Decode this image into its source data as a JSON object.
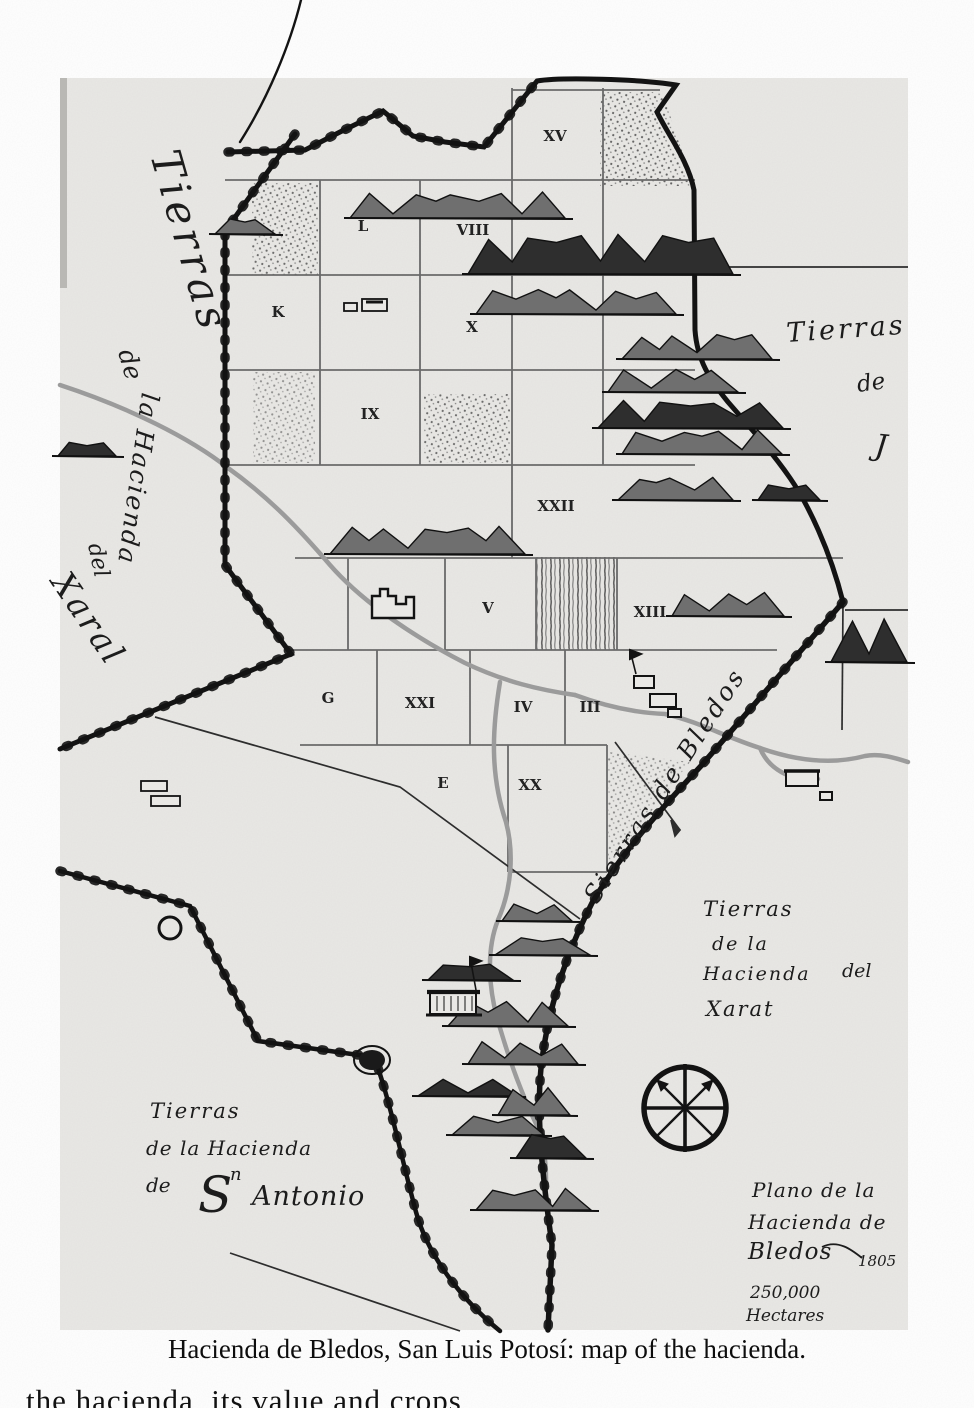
{
  "page": {
    "caption": "Hacienda de Bledos, San Luis Potosí: map of the hacienda.",
    "cropped_bottom_text": "the hacienda, its value and crops"
  },
  "map": {
    "territory_labels": {
      "west": [
        "Tierras",
        "de",
        "la Hacienda",
        "del",
        "Xaral"
      ],
      "east_edge": [
        "Tierras",
        "de",
        "J"
      ],
      "sierras_boundary": "Sierras de Bledos",
      "southeast": [
        "Tierras",
        "de la",
        "Hacienda",
        "del",
        "Xarat"
      ],
      "southwest": [
        "Tierras",
        "de la Hacienda",
        "de",
        "S",
        "n",
        "Antonio"
      ]
    },
    "cartouche": {
      "title_line1": "Plano de la",
      "title_line2": "Hacienda de",
      "title_line3": "Bledos",
      "year": "1805",
      "area_value": "250,000",
      "area_unit": "Hectares"
    },
    "parcels": [
      {
        "label": "XV",
        "x": 555,
        "y": 141
      },
      {
        "label": "L",
        "x": 363,
        "y": 231
      },
      {
        "label": "VIII",
        "x": 473,
        "y": 235
      },
      {
        "label": "K",
        "x": 278,
        "y": 317
      },
      {
        "label": "X",
        "x": 472,
        "y": 332
      },
      {
        "label": "IX",
        "x": 370,
        "y": 419
      },
      {
        "label": "XXII",
        "x": 556,
        "y": 511
      },
      {
        "label": "V",
        "x": 488,
        "y": 613
      },
      {
        "label": "XIII",
        "x": 650,
        "y": 617
      },
      {
        "label": "G",
        "x": 328,
        "y": 703
      },
      {
        "label": "XXI",
        "x": 420,
        "y": 708
      },
      {
        "label": "IV",
        "x": 523,
        "y": 712
      },
      {
        "label": "III",
        "x": 590,
        "y": 712
      },
      {
        "label": "E",
        "x": 443,
        "y": 788
      },
      {
        "label": "XX",
        "x": 530,
        "y": 790
      }
    ],
    "colors": {
      "paper": "#e9e8e5",
      "ink": "#161616",
      "grid": "#6a6a6a",
      "river": "#9b9b9b",
      "mountain": "#6f6f6f",
      "mountain_dark": "#2e2e2e"
    }
  }
}
